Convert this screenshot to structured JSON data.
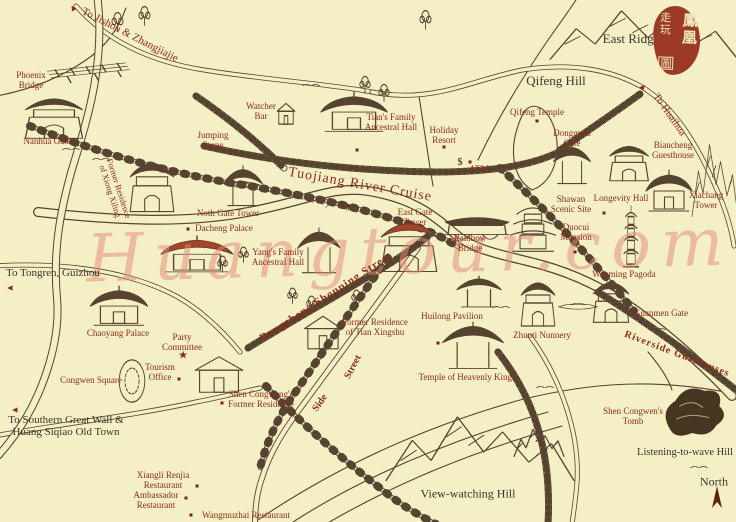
{
  "colors": {
    "background": "#f5efc6",
    "ink": "#564330",
    "ink_dark": "#46351f",
    "label_red": "#8e2b18",
    "label_black": "#3b332a",
    "seal_red": "#9c3a26",
    "building_red_accent": "#a8422a",
    "marker_red": "#7a2415",
    "watermark_pink": "#e08a75"
  },
  "seal": {
    "right_column": "鳳凰",
    "left_column": "走玩",
    "bottom_character": "圖"
  },
  "watermark": {
    "text": "Huangtour.com"
  },
  "compass": {
    "label": "North"
  },
  "labels": [
    {
      "id": "to-jishou-zhangjiajie",
      "lines": [
        "To Jishou & Zhangjiajie"
      ],
      "x": 130,
      "y": 35,
      "rot": 27,
      "size": 11,
      "color": "red"
    },
    {
      "id": "phoenix-bridge",
      "lines": [
        "Phoenix",
        "Bridge"
      ],
      "x": 31,
      "y": 81,
      "rot": 0,
      "size": 9,
      "color": "red"
    },
    {
      "id": "nanhua-gate",
      "lines": [
        "Nanhua Gate"
      ],
      "x": 47,
      "y": 142,
      "rot": 0,
      "size": 9,
      "color": "red"
    },
    {
      "id": "jumping-stone",
      "lines": [
        "Jumping",
        "Stone"
      ],
      "x": 213,
      "y": 141,
      "rot": 0,
      "size": 9,
      "color": "red"
    },
    {
      "id": "watcher-bar",
      "lines": [
        "Watcher",
        "Bar"
      ],
      "x": 261,
      "y": 112,
      "rot": 0,
      "size": 9,
      "color": "red"
    },
    {
      "id": "tians-family-ancestral-hall",
      "lines": [
        "Tian's Family",
        "Ancestral Hall"
      ],
      "x": 391,
      "y": 123,
      "rot": 0,
      "size": 9,
      "color": "red"
    },
    {
      "id": "holiday-resort",
      "lines": [
        "Holiday",
        "Resort"
      ],
      "x": 444,
      "y": 136,
      "rot": 0,
      "size": 9,
      "color": "red"
    },
    {
      "id": "atm",
      "lines": [
        "ATM"
      ],
      "x": 479,
      "y": 170,
      "rot": 0,
      "size": 9.5,
      "color": "red"
    },
    {
      "id": "qifeng-temple",
      "lines": [
        "Qifeng Temple"
      ],
      "x": 537,
      "y": 113,
      "rot": 0,
      "size": 9,
      "color": "red"
    },
    {
      "id": "dongguan-gate",
      "lines": [
        "Dongguan",
        "Gate"
      ],
      "x": 572,
      "y": 139,
      "rot": 0,
      "size": 9,
      "color": "red"
    },
    {
      "id": "biancheng-guesthouse",
      "lines": [
        "Biancheng",
        "Guesthouse"
      ],
      "x": 673,
      "y": 151,
      "rot": 0,
      "size": 9,
      "color": "red"
    },
    {
      "id": "to-huaihua",
      "lines": [
        "To Huaihua"
      ],
      "x": 669,
      "y": 115,
      "rot": 55,
      "size": 10.5,
      "color": "red"
    },
    {
      "id": "east-ridge",
      "lines": [
        "East Ridge"
      ],
      "x": 631,
      "y": 39,
      "rot": 0,
      "size": 13,
      "color": "black"
    },
    {
      "id": "qifeng-hill",
      "lines": [
        "Qifeng Hill"
      ],
      "x": 556,
      "y": 81,
      "rot": 0,
      "size": 13,
      "color": "black"
    },
    {
      "id": "xiachang-tower",
      "lines": [
        "Xiachang",
        "Tower"
      ],
      "x": 706,
      "y": 201,
      "rot": 0,
      "size": 9,
      "color": "red"
    },
    {
      "id": "longevity-hall",
      "lines": [
        "Longevity Hall"
      ],
      "x": 621,
      "y": 199,
      "rot": 0,
      "size": 9,
      "color": "red"
    },
    {
      "id": "shawan-scenic-site",
      "lines": [
        "Shawan",
        "Scenic Site"
      ],
      "x": 571,
      "y": 205,
      "rot": 0,
      "size": 9,
      "color": "red"
    },
    {
      "id": "duocui-mansion",
      "lines": [
        "Duocui",
        "Mansion"
      ],
      "x": 576,
      "y": 233,
      "rot": 0,
      "size": 9,
      "color": "red"
    },
    {
      "id": "wanming-pagoda",
      "lines": [
        "Wanming Pagoda"
      ],
      "x": 624,
      "y": 275,
      "rot": 0,
      "size": 9,
      "color": "red"
    },
    {
      "id": "guanmen-gate",
      "lines": [
        "Guanmen Gate"
      ],
      "x": 661,
      "y": 314,
      "rot": 0,
      "size": 9,
      "color": "red"
    },
    {
      "id": "riverside-gusthouses",
      "lines": [
        "Riverside Gusthouses"
      ],
      "x": 677,
      "y": 354,
      "rot": 21,
      "size": 10,
      "color": "red",
      "bold": true,
      "ls": 1
    },
    {
      "id": "noth-gate-tower",
      "lines": [
        "Noth Gate Tower"
      ],
      "x": 228,
      "y": 214,
      "rot": 0,
      "size": 9,
      "color": "red"
    },
    {
      "id": "dacheng-palace",
      "lines": [
        "Dacheng Palace"
      ],
      "x": 224,
      "y": 229,
      "rot": 0,
      "size": 9,
      "color": "red"
    },
    {
      "id": "tuojiang-river-cruise",
      "lines": [
        "Tuojiang River Cruise"
      ],
      "x": 360,
      "y": 185,
      "rot": 10,
      "size": 14,
      "color": "red",
      "ls": 1
    },
    {
      "id": "ancient-city-wall",
      "lines": [
        "Ancient City Wall"
      ],
      "x": 312,
      "y": 200,
      "rot": 13,
      "size": 9,
      "color": "ink"
    },
    {
      "id": "east-gate-tower",
      "lines": [
        "East Gate",
        "Tower"
      ],
      "x": 415,
      "y": 218,
      "rot": 0,
      "size": 9,
      "color": "red"
    },
    {
      "id": "rainbow-bridge",
      "lines": [
        "Rainbow",
        "Bridge"
      ],
      "x": 470,
      "y": 244,
      "rot": 0,
      "size": 9,
      "color": "red"
    },
    {
      "id": "yangs-family-ancestral-hall",
      "lines": [
        "Yang's Family",
        "Ancestral Hall"
      ],
      "x": 278,
      "y": 258,
      "rot": 0,
      "size": 9,
      "color": "red"
    },
    {
      "id": "dongzheng-shopping-street",
      "lines": [
        "Dongzheng Shopping Street"
      ],
      "x": 326,
      "y": 297,
      "rot": -33,
      "size": 11,
      "color": "red",
      "bold": true,
      "ls": 1
    },
    {
      "id": "former-residence-of-tian-xingshu",
      "lines": [
        "Former Residence",
        "of Tian Xingshu"
      ],
      "x": 375,
      "y": 328,
      "rot": 0,
      "size": 9,
      "color": "red"
    },
    {
      "id": "huilong-pavilion",
      "lines": [
        "Huilong Pavilion"
      ],
      "x": 452,
      "y": 317,
      "rot": 0,
      "size": 9,
      "color": "red"
    },
    {
      "id": "zhunti-nunnery",
      "lines": [
        "Zhunti Nunnery"
      ],
      "x": 542,
      "y": 336,
      "rot": 0,
      "size": 9,
      "color": "red"
    },
    {
      "id": "temple-of-heavenly-kings",
      "lines": [
        "Temple of Heavenly Kings"
      ],
      "x": 467,
      "y": 378,
      "rot": 0,
      "size": 9,
      "color": "red"
    },
    {
      "id": "side-street-side",
      "lines": [
        "Side"
      ],
      "x": 320,
      "y": 403,
      "rot": -55,
      "size": 10,
      "color": "red",
      "bold": true
    },
    {
      "id": "side-street-street",
      "lines": [
        "Street"
      ],
      "x": 353,
      "y": 367,
      "rot": -62,
      "size": 10,
      "color": "red",
      "bold": true
    },
    {
      "id": "to-tongren-guizhou",
      "lines": [
        "To Tongren, Guizhou"
      ],
      "x": 53,
      "y": 273,
      "rot": 0,
      "size": 11,
      "color": "black"
    },
    {
      "id": "chaoyang-palace",
      "lines": [
        "Chaoyang Palace"
      ],
      "x": 118,
      "y": 334,
      "rot": 0,
      "size": 9,
      "color": "red"
    },
    {
      "id": "party-committee",
      "lines": [
        "Party",
        "Committee"
      ],
      "x": 182,
      "y": 343,
      "rot": 0,
      "size": 9,
      "color": "red"
    },
    {
      "id": "congwen-square",
      "lines": [
        "Congwen Square"
      ],
      "x": 91,
      "y": 381,
      "rot": 0,
      "size": 9,
      "color": "red"
    },
    {
      "id": "tourism-office",
      "lines": [
        "Tourism",
        "Office"
      ],
      "x": 160,
      "y": 373,
      "rot": 0,
      "size": 9,
      "color": "red"
    },
    {
      "id": "shen-congwengs-former-residence",
      "lines": [
        "Shen Congweng's",
        "Former Residence"
      ],
      "x": 261,
      "y": 400,
      "rot": 0,
      "size": 9,
      "color": "red"
    },
    {
      "id": "to-southern-great-wall",
      "lines": [
        "To Southern Great Wall &",
        "Huang Siqiao Old Town"
      ],
      "x": 66,
      "y": 426,
      "rot": 0,
      "size": 11,
      "color": "black"
    },
    {
      "id": "xiangli-renjia-restaurant",
      "lines": [
        "Xiangli Renjia",
        "Restaurant"
      ],
      "x": 163,
      "y": 481,
      "rot": 0,
      "size": 9,
      "color": "red"
    },
    {
      "id": "ambassador-restaurant",
      "lines": [
        "Ambassador",
        "Restaurant"
      ],
      "x": 156,
      "y": 501,
      "rot": 0,
      "size": 9,
      "color": "red"
    },
    {
      "id": "wangmuzhai-restaurant",
      "lines": [
        "Wangmuzhai Restaurant"
      ],
      "x": 246,
      "y": 516,
      "rot": 0,
      "size": 9,
      "color": "red"
    },
    {
      "id": "view-watching-hill",
      "lines": [
        "View-watching Hill"
      ],
      "x": 468,
      "y": 494,
      "rot": 0,
      "size": 12,
      "color": "black"
    },
    {
      "id": "shen-congwens-tomb",
      "lines": [
        "Shen Congwen's",
        "Tomb"
      ],
      "x": 633,
      "y": 417,
      "rot": 0,
      "size": 9,
      "color": "red"
    },
    {
      "id": "listening-to-wave-hill",
      "lines": [
        "Listening-to-wave Hill"
      ],
      "x": 685,
      "y": 453,
      "rot": 0,
      "size": 10.5,
      "color": "black"
    },
    {
      "id": "north",
      "lines": [
        "North"
      ],
      "x": 714,
      "y": 482,
      "rot": 0,
      "size": 12,
      "color": "black"
    },
    {
      "id": "former-residence-of-xiong-xiling",
      "lines": [
        "Former Residence",
        "of Xiong Xiling"
      ],
      "x": 114,
      "y": 190,
      "rot": 72,
      "size": 8.5,
      "color": "red"
    }
  ],
  "markers": [
    {
      "type": "triangle",
      "x": 73,
      "y": 8,
      "rot": -30
    },
    {
      "type": "triangle",
      "x": 643,
      "y": 87,
      "rot": 40
    },
    {
      "type": "triangle",
      "x": 10,
      "y": 288,
      "rot": -90
    },
    {
      "type": "triangle",
      "x": 15,
      "y": 410,
      "rot": -90
    },
    {
      "type": "star",
      "x": 183,
      "y": 356,
      "rot": 0
    },
    {
      "type": "dollar",
      "x": 460,
      "y": 163,
      "rot": 0
    },
    {
      "type": "north-arrow",
      "x": 717,
      "y": 500,
      "rot": 0
    },
    {
      "type": "dot",
      "x": 357,
      "y": 150
    },
    {
      "type": "dot",
      "x": 348,
      "y": 206
    },
    {
      "type": "dot",
      "x": 537,
      "y": 121
    },
    {
      "type": "dot",
      "x": 444,
      "y": 147
    },
    {
      "type": "dot",
      "x": 470,
      "y": 162
    },
    {
      "type": "dot",
      "x": 188,
      "y": 229
    },
    {
      "type": "dot",
      "x": 604,
      "y": 213
    },
    {
      "type": "dot",
      "x": 575,
      "y": 252
    },
    {
      "type": "dot",
      "x": 438,
      "y": 343
    },
    {
      "type": "dot",
      "x": 179,
      "y": 379
    },
    {
      "type": "dot",
      "x": 222,
      "y": 403
    },
    {
      "type": "dot",
      "x": 197,
      "y": 486
    },
    {
      "type": "dot",
      "x": 186,
      "y": 498
    },
    {
      "type": "dot",
      "x": 191,
      "y": 515
    }
  ],
  "buildings": [
    {
      "icon": "trestle-bridge",
      "name": "phoenix-bridge",
      "x": 50,
      "y": 56,
      "w": 80,
      "h": 34
    },
    {
      "icon": "gate",
      "name": "nanhua-gate",
      "x": 20,
      "y": 96,
      "w": 68,
      "h": 46
    },
    {
      "icon": "house",
      "name": "watcher-bar",
      "x": 276,
      "y": 100,
      "w": 20,
      "h": 28
    },
    {
      "icon": "temple",
      "name": "tians-family-ancestral-hall",
      "x": 318,
      "y": 90,
      "w": 72,
      "h": 48
    },
    {
      "icon": "gate",
      "name": "xiong-xiling-former-residence",
      "x": 126,
      "y": 160,
      "w": 52,
      "h": 56
    },
    {
      "icon": "pavilion",
      "name": "north-gate-tower",
      "x": 222,
      "y": 166,
      "w": 42,
      "h": 46
    },
    {
      "icon": "temple",
      "name": "dacheng-palace",
      "x": 158,
      "y": 234,
      "w": 78,
      "h": 44,
      "tint": "red"
    },
    {
      "icon": "gate",
      "name": "east-gate-tower",
      "x": 376,
      "y": 220,
      "w": 66,
      "h": 56,
      "tint": "red"
    },
    {
      "icon": "pavilion",
      "name": "yangs-family-ancestral-hall",
      "x": 296,
      "y": 228,
      "w": 46,
      "h": 52
    },
    {
      "icon": "covered-bridge",
      "name": "rainbow-bridge",
      "x": 444,
      "y": 208,
      "w": 66,
      "h": 44
    },
    {
      "icon": "pavilion",
      "name": "dongguan-gate",
      "x": 552,
      "y": 144,
      "w": 40,
      "h": 46
    },
    {
      "icon": "gate",
      "name": "biancheng-guesthouse",
      "x": 606,
      "y": 144,
      "w": 46,
      "h": 40
    },
    {
      "icon": "temple",
      "name": "xiachang-tower",
      "x": 644,
      "y": 168,
      "w": 50,
      "h": 50
    },
    {
      "icon": "pagoda",
      "name": "duocui-mansion",
      "x": 506,
      "y": 198,
      "w": 54,
      "h": 62
    },
    {
      "icon": "thin-pagoda",
      "name": "wanming-pagoda",
      "x": 616,
      "y": 206,
      "w": 30,
      "h": 66
    },
    {
      "icon": "gate",
      "name": "guanmen-gate",
      "x": 590,
      "y": 280,
      "w": 42,
      "h": 46
    },
    {
      "icon": "pavilion",
      "name": "huilong-pavilion",
      "x": 455,
      "y": 276,
      "w": 48,
      "h": 36
    },
    {
      "icon": "gate",
      "name": "zhunti-nunnery",
      "x": 518,
      "y": 280,
      "w": 40,
      "h": 50
    },
    {
      "icon": "pavilion",
      "name": "temple-of-heavenly-kings",
      "x": 440,
      "y": 322,
      "w": 66,
      "h": 54
    },
    {
      "icon": "temple",
      "name": "chaoyang-palace",
      "x": 88,
      "y": 284,
      "w": 62,
      "h": 48
    },
    {
      "icon": "house",
      "name": "shen-congwens-former-residence",
      "x": 192,
      "y": 351,
      "w": 54,
      "h": 48
    },
    {
      "icon": "house",
      "name": "tian-xingshu-former-residence",
      "x": 302,
      "y": 311,
      "w": 42,
      "h": 44
    },
    {
      "icon": "plaza-oval",
      "name": "congwen-square",
      "x": 116,
      "y": 358,
      "w": 32,
      "h": 46
    },
    {
      "icon": "dark-hill",
      "name": "listening-to-wave-hill",
      "x": 654,
      "y": 378,
      "w": 76,
      "h": 64
    },
    {
      "icon": "mountains",
      "name": "east-ridge-mountains",
      "x": 550,
      "y": -2,
      "w": 188,
      "h": 64
    },
    {
      "icon": "mountains",
      "name": "right-edge-mountains",
      "x": 692,
      "y": 126,
      "w": 46,
      "h": 94
    },
    {
      "icon": "mountains",
      "name": "view-watching-hill-range",
      "x": 386,
      "y": 400,
      "w": 188,
      "h": 84
    },
    {
      "icon": "mountains",
      "name": "small-hills",
      "x": 514,
      "y": 422,
      "w": 50,
      "h": 36
    },
    {
      "icon": "boat",
      "name": "river-boat-west",
      "x": 224,
      "y": 176,
      "w": 36,
      "h": 16
    },
    {
      "icon": "boat",
      "name": "river-boat-east",
      "x": 558,
      "y": 298,
      "w": 40,
      "h": 16
    },
    {
      "icon": "tree",
      "name": "tree",
      "x": 110,
      "y": 10,
      "w": 15,
      "h": 22
    },
    {
      "icon": "tree",
      "name": "tree",
      "x": 137,
      "y": 4,
      "w": 15,
      "h": 22
    },
    {
      "icon": "tree",
      "name": "tree",
      "x": 358,
      "y": 74,
      "w": 14,
      "h": 20
    },
    {
      "icon": "tree",
      "name": "tree",
      "x": 377,
      "y": 82,
      "w": 14,
      "h": 20
    },
    {
      "icon": "tree",
      "name": "tree",
      "x": 418,
      "y": 8,
      "w": 15,
      "h": 22
    },
    {
      "icon": "tree",
      "name": "tree",
      "x": 286,
      "y": 286,
      "w": 13,
      "h": 18
    },
    {
      "icon": "tree",
      "name": "tree",
      "x": 305,
      "y": 294,
      "w": 13,
      "h": 18
    },
    {
      "icon": "tree",
      "name": "tree",
      "x": 350,
      "y": 288,
      "w": 13,
      "h": 18
    },
    {
      "icon": "tree",
      "name": "tree",
      "x": 237,
      "y": 245,
      "w": 13,
      "h": 18
    },
    {
      "icon": "tree",
      "name": "tree",
      "x": 216,
      "y": 254,
      "w": 13,
      "h": 18
    },
    {
      "icon": "grass",
      "name": "grass",
      "x": 62,
      "y": 144,
      "w": 18,
      "h": 8
    },
    {
      "icon": "grass",
      "name": "grass",
      "x": 92,
      "y": 154,
      "w": 18,
      "h": 8
    },
    {
      "icon": "grass",
      "name": "grass",
      "x": 302,
      "y": 80,
      "w": 18,
      "h": 8
    },
    {
      "icon": "grass",
      "name": "grass",
      "x": 536,
      "y": 382,
      "w": 18,
      "h": 8
    },
    {
      "icon": "grass",
      "name": "grass",
      "x": 648,
      "y": 324,
      "w": 18,
      "h": 8
    },
    {
      "icon": "grass",
      "name": "grass",
      "x": 690,
      "y": 462,
      "w": 18,
      "h": 8
    },
    {
      "icon": "grass",
      "name": "grass",
      "x": 492,
      "y": 302,
      "w": 18,
      "h": 8
    }
  ]
}
